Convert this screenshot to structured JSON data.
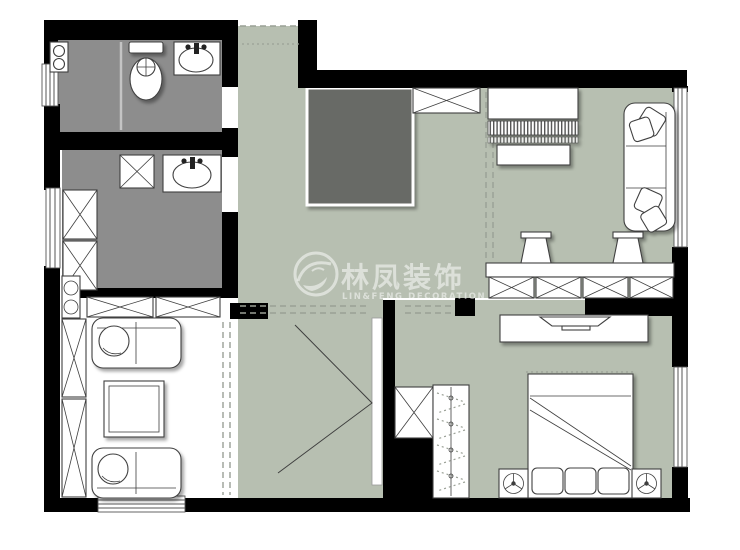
{
  "watermark": {
    "title": "林凤装饰",
    "subtitle": "LIN&FENG DECORATION",
    "logo": "linfeng-swirl-logo"
  },
  "colors": {
    "wall": "#000000",
    "floor_main": "#b7bfb1",
    "floor_wet": "#8d8d8d",
    "floor_dark": "#686a66",
    "furniture_fill": "#ffffff",
    "line": "#3f3f3f",
    "dash": "#9aa096",
    "watermark": "rgba(255,255,255,0.55)"
  },
  "plan": {
    "type": "residential-floor-plan",
    "rooms": [
      {
        "id": "bathroom",
        "floor": "wet"
      },
      {
        "id": "kitchen",
        "floor": "wet"
      },
      {
        "id": "entry-corridor",
        "floor": "main"
      },
      {
        "id": "living-dining-room",
        "floor": "main"
      },
      {
        "id": "hallway",
        "floor": "main"
      },
      {
        "id": "bedroom",
        "floor": "main"
      },
      {
        "id": "dark-core-area",
        "floor": "dark"
      }
    ],
    "furniture_icons": [
      "washer-icon",
      "toilet-icon",
      "sink-icon",
      "cabinet-x-icon",
      "piano-icon",
      "piano-bench-icon",
      "sofa-icon",
      "bar-counter-icon",
      "bar-stool-icon",
      "tv-icon",
      "tv-cabinet-icon",
      "wardrobe-hanger-icon",
      "double-bed-icon",
      "nightstand-lamp-icon",
      "coffee-table-icon",
      "loveseat-icon",
      "window-icon",
      "door-opening-icon"
    ]
  }
}
